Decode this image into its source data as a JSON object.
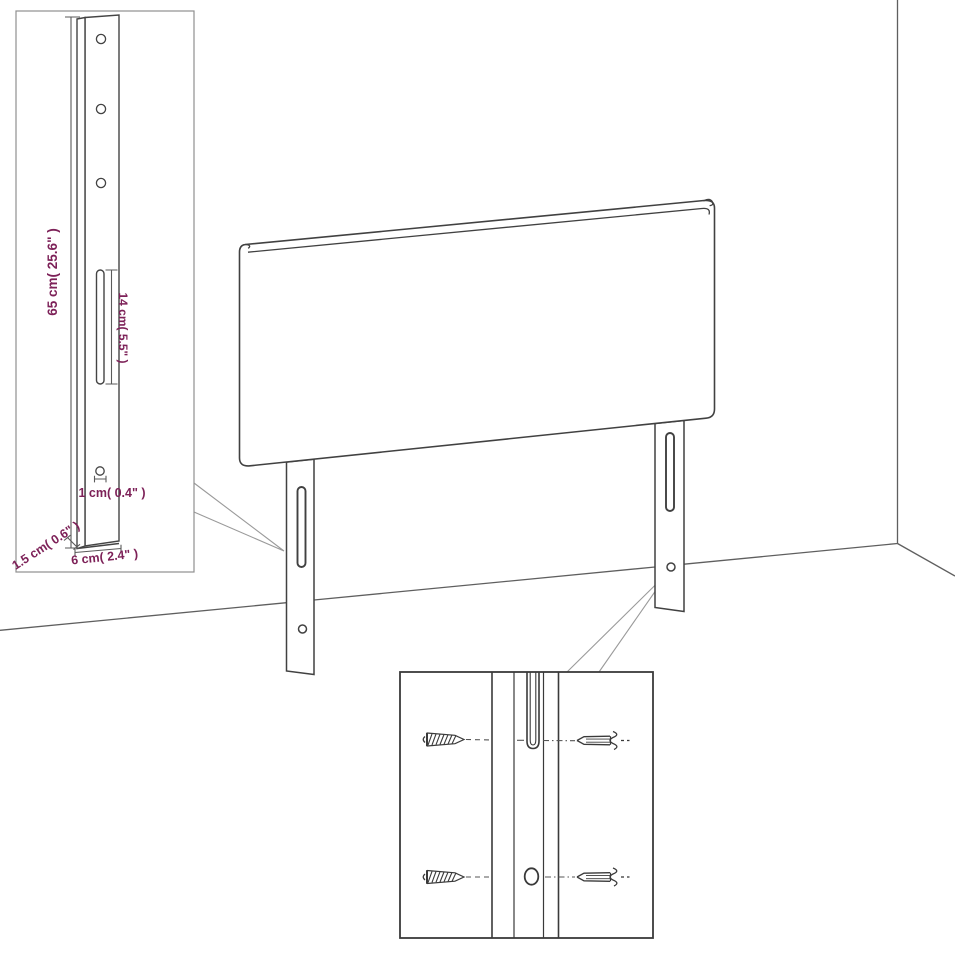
{
  "diagram": {
    "subject": "headboard-wall-mount-dimension-diagram",
    "background_color": "#ffffff",
    "outline_color": "#414141",
    "secondary_line_color": "#5f5f5f",
    "inset_border_color": "#8f8f8f",
    "leader_line_color": "#9a9a9a",
    "dimension_text_color": "#7d2158",
    "inset": {
      "height_label": "65 cm( 25.6\" )",
      "slot_length_label": "14 cm( 5.5\" )",
      "hole_diameter_label": "1 cm( 0.4\" )",
      "thickness_label": "1.5 cm( 0.6\" )",
      "width_label": "6 cm( 2.4\" )"
    }
  }
}
